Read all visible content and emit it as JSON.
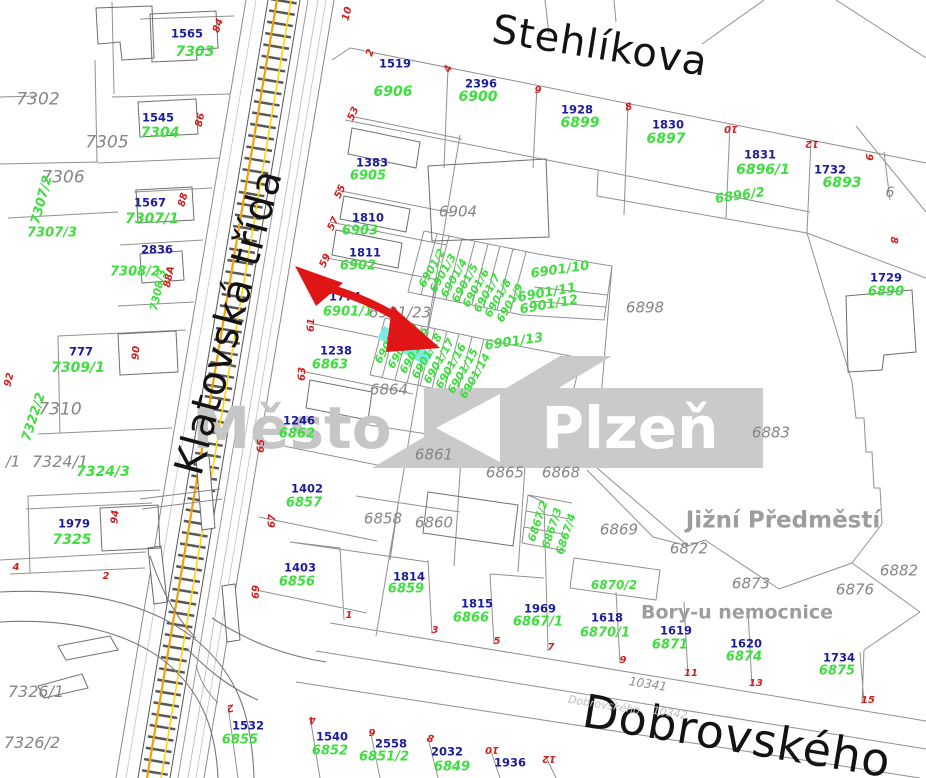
{
  "map": {
    "watermark": {
      "prefix": "Město",
      "city": "Plzeň"
    },
    "labels": [
      {
        "t": "Město",
        "x": 292,
        "y": 428,
        "c": "wm1"
      },
      {
        "t": "Plzeň",
        "x": 630,
        "y": 428,
        "c": "wm2"
      },
      {
        "t": "Stehlíkova",
        "x": 600,
        "y": 46,
        "c": "street",
        "r": 9,
        "s": 40
      },
      {
        "t": "Klatovská třída",
        "x": 229,
        "y": 322,
        "c": "street",
        "r": -75,
        "s": 40
      },
      {
        "t": "Dobrovského",
        "x": 737,
        "y": 736,
        "c": "street",
        "r": 9.5,
        "s": 46
      },
      {
        "t": "Jižní Předměstí",
        "x": 783,
        "y": 521,
        "c": "area",
        "s": 23
      },
      {
        "t": "Bory-u nemocnice",
        "x": 737,
        "y": 613,
        "c": "area",
        "s": 19
      },
      {
        "t": "10341",
        "x": 648,
        "y": 684,
        "c": "road",
        "r": 9
      },
      {
        "t": "Dobrovského",
        "x": 604,
        "y": 705,
        "c": "f",
        "r": 9
      },
      {
        "t": "10342",
        "x": 670,
        "y": 713,
        "c": "f",
        "r": 9
      },
      {
        "t": "7302",
        "x": 38,
        "y": 100,
        "c": "gr",
        "s": 17
      },
      {
        "t": "7305",
        "x": 107,
        "y": 143,
        "c": "gr",
        "s": 17
      },
      {
        "t": "7306",
        "x": 63,
        "y": 178,
        "c": "gr",
        "s": 17
      },
      {
        "t": "7310",
        "x": 60,
        "y": 410,
        "c": "gr",
        "s": 17
      },
      {
        "t": "/1",
        "x": 13,
        "y": 462,
        "c": "gr",
        "s": 15
      },
      {
        "t": "7324/1",
        "x": 60,
        "y": 462,
        "c": "gr",
        "s": 16
      },
      {
        "t": "7326/1",
        "x": 36,
        "y": 692,
        "c": "gr",
        "s": 16
      },
      {
        "t": "7326/2",
        "x": 32,
        "y": 743,
        "c": "gr",
        "s": 16
      },
      {
        "t": "6904",
        "x": 458,
        "y": 212,
        "c": "gr"
      },
      {
        "t": "6901/23",
        "x": 400,
        "y": 313,
        "c": "gr"
      },
      {
        "t": "6898",
        "x": 645,
        "y": 308,
        "c": "gr"
      },
      {
        "t": "6864",
        "x": 389,
        "y": 390,
        "c": "gr"
      },
      {
        "t": "6861",
        "x": 434,
        "y": 455,
        "c": "gr"
      },
      {
        "t": "6865",
        "x": 505,
        "y": 473,
        "c": "gr"
      },
      {
        "t": "6868",
        "x": 561,
        "y": 473,
        "c": "gr"
      },
      {
        "t": "6883",
        "x": 771,
        "y": 433,
        "c": "gr"
      },
      {
        "t": "6858",
        "x": 383,
        "y": 519,
        "c": "gr"
      },
      {
        "t": "6860",
        "x": 434,
        "y": 523,
        "c": "gr"
      },
      {
        "t": "6869",
        "x": 619,
        "y": 530,
        "c": "gr"
      },
      {
        "t": "6872",
        "x": 689,
        "y": 549,
        "c": "gr"
      },
      {
        "t": "6873",
        "x": 751,
        "y": 584,
        "c": "gr"
      },
      {
        "t": "6876",
        "x": 855,
        "y": 590,
        "c": "gr"
      },
      {
        "t": "6882",
        "x": 899,
        "y": 571,
        "c": "gr"
      },
      {
        "t": "6",
        "x": 890,
        "y": 193,
        "c": "gr",
        "s": 14
      },
      {
        "t": "1565",
        "x": 187,
        "y": 34,
        "c": "b"
      },
      {
        "t": "1545",
        "x": 158,
        "y": 118,
        "c": "b"
      },
      {
        "t": "1567",
        "x": 150,
        "y": 203,
        "c": "b"
      },
      {
        "t": "2836",
        "x": 157,
        "y": 250,
        "c": "b"
      },
      {
        "t": "777",
        "x": 81,
        "y": 352,
        "c": "b"
      },
      {
        "t": "1979",
        "x": 74,
        "y": 524,
        "c": "b"
      },
      {
        "t": "1519",
        "x": 395,
        "y": 64,
        "c": "b"
      },
      {
        "t": "2396",
        "x": 481,
        "y": 84,
        "c": "b"
      },
      {
        "t": "1928",
        "x": 577,
        "y": 110,
        "c": "b"
      },
      {
        "t": "1830",
        "x": 668,
        "y": 125,
        "c": "b"
      },
      {
        "t": "1831",
        "x": 760,
        "y": 155,
        "c": "b"
      },
      {
        "t": "1732",
        "x": 830,
        "y": 170,
        "c": "b"
      },
      {
        "t": "1729",
        "x": 886,
        "y": 278,
        "c": "b"
      },
      {
        "t": "1383",
        "x": 372,
        "y": 163,
        "c": "b"
      },
      {
        "t": "1810",
        "x": 368,
        "y": 218,
        "c": "b"
      },
      {
        "t": "1811",
        "x": 365,
        "y": 253,
        "c": "b"
      },
      {
        "t": "1774",
        "x": 345,
        "y": 297,
        "c": "b"
      },
      {
        "t": "1238",
        "x": 336,
        "y": 351,
        "c": "b"
      },
      {
        "t": "1246",
        "x": 299,
        "y": 421,
        "c": "b"
      },
      {
        "t": "1402",
        "x": 307,
        "y": 489,
        "c": "b"
      },
      {
        "t": "1403",
        "x": 300,
        "y": 568,
        "c": "b"
      },
      {
        "t": "1814",
        "x": 409,
        "y": 577,
        "c": "b"
      },
      {
        "t": "1815",
        "x": 477,
        "y": 604,
        "c": "b"
      },
      {
        "t": "1969",
        "x": 540,
        "y": 609,
        "c": "b"
      },
      {
        "t": "1618",
        "x": 607,
        "y": 618,
        "c": "b"
      },
      {
        "t": "1619",
        "x": 676,
        "y": 631,
        "c": "b"
      },
      {
        "t": "1620",
        "x": 746,
        "y": 644,
        "c": "b"
      },
      {
        "t": "1734",
        "x": 839,
        "y": 658,
        "c": "b"
      },
      {
        "t": "1532",
        "x": 248,
        "y": 726,
        "c": "b"
      },
      {
        "t": "1540",
        "x": 332,
        "y": 737,
        "c": "b"
      },
      {
        "t": "2558",
        "x": 391,
        "y": 744,
        "c": "b"
      },
      {
        "t": "2032",
        "x": 447,
        "y": 752,
        "c": "b"
      },
      {
        "t": "1936",
        "x": 510,
        "y": 763,
        "c": "b"
      },
      {
        "t": "7303",
        "x": 195,
        "y": 52,
        "c": "g",
        "s": 14
      },
      {
        "t": "7304",
        "x": 160,
        "y": 133,
        "c": "g",
        "s": 14
      },
      {
        "t": "7307/1",
        "x": 152,
        "y": 219,
        "c": "g",
        "s": 14
      },
      {
        "t": "7307/2",
        "x": 42,
        "y": 200,
        "c": "g",
        "r": -75
      },
      {
        "t": "7307/3",
        "x": 52,
        "y": 233,
        "c": "g"
      },
      {
        "t": "7308/2",
        "x": 135,
        "y": 272,
        "c": "g"
      },
      {
        "t": "7308/3",
        "x": 158,
        "y": 290,
        "c": "g",
        "r": -78,
        "s": 11
      },
      {
        "t": "7309/1",
        "x": 78,
        "y": 368,
        "c": "g",
        "s": 14
      },
      {
        "t": "7322/2",
        "x": 34,
        "y": 417,
        "c": "g",
        "r": -72
      },
      {
        "t": "7324/3",
        "x": 103,
        "y": 472,
        "c": "g",
        "s": 14
      },
      {
        "t": "7325",
        "x": 72,
        "y": 540,
        "c": "g",
        "s": 14
      },
      {
        "t": "6906",
        "x": 393,
        "y": 92,
        "c": "g",
        "s": 14
      },
      {
        "t": "6900",
        "x": 478,
        "y": 97,
        "c": "g",
        "s": 14
      },
      {
        "t": "6899",
        "x": 580,
        "y": 123,
        "c": "g",
        "s": 14
      },
      {
        "t": "6897",
        "x": 666,
        "y": 139,
        "c": "g",
        "s": 14
      },
      {
        "t": "6896/1",
        "x": 763,
        "y": 170,
        "c": "g",
        "s": 14
      },
      {
        "t": "6896/2",
        "x": 740,
        "y": 196,
        "c": "g",
        "r": -8
      },
      {
        "t": "6893",
        "x": 842,
        "y": 183,
        "c": "g",
        "s": 14
      },
      {
        "t": "6890",
        "x": 886,
        "y": 292,
        "c": "g"
      },
      {
        "t": "6905",
        "x": 368,
        "y": 176,
        "c": "g"
      },
      {
        "t": "6903",
        "x": 360,
        "y": 231,
        "c": "g"
      },
      {
        "t": "6902",
        "x": 358,
        "y": 266,
        "c": "g"
      },
      {
        "t": "6901/1",
        "x": 348,
        "y": 312,
        "c": "g"
      },
      {
        "t": "6863",
        "x": 330,
        "y": 365,
        "c": "g"
      },
      {
        "t": "6862",
        "x": 297,
        "y": 434,
        "c": "g"
      },
      {
        "t": "6857",
        "x": 304,
        "y": 503,
        "c": "g"
      },
      {
        "t": "6856",
        "x": 297,
        "y": 582,
        "c": "g"
      },
      {
        "t": "6859",
        "x": 406,
        "y": 589,
        "c": "g"
      },
      {
        "t": "6866",
        "x": 471,
        "y": 618,
        "c": "g"
      },
      {
        "t": "6867/1",
        "x": 538,
        "y": 622,
        "c": "g"
      },
      {
        "t": "6870/1",
        "x": 605,
        "y": 633,
        "c": "g"
      },
      {
        "t": "6870/2",
        "x": 614,
        "y": 585,
        "c": "g",
        "s": 12
      },
      {
        "t": "6871",
        "x": 670,
        "y": 645,
        "c": "g"
      },
      {
        "t": "6874",
        "x": 744,
        "y": 657,
        "c": "g"
      },
      {
        "t": "6875",
        "x": 837,
        "y": 671,
        "c": "g"
      },
      {
        "t": "6855",
        "x": 240,
        "y": 740,
        "c": "g"
      },
      {
        "t": "6852",
        "x": 330,
        "y": 751,
        "c": "g"
      },
      {
        "t": "6851/2",
        "x": 384,
        "y": 757,
        "c": "g"
      },
      {
        "t": "6849",
        "x": 452,
        "y": 767,
        "c": "g"
      },
      {
        "t": "6867/2",
        "x": 538,
        "y": 521,
        "c": "g",
        "r": -72,
        "s": 11
      },
      {
        "t": "6867/3",
        "x": 552,
        "y": 528,
        "c": "g",
        "r": -72,
        "s": 11
      },
      {
        "t": "6867/4",
        "x": 566,
        "y": 534,
        "c": "g",
        "r": -72,
        "s": 11
      },
      {
        "t": "6901/10",
        "x": 560,
        "y": 270,
        "c": "g",
        "r": -8
      },
      {
        "t": "6901/11",
        "x": 547,
        "y": 293,
        "c": "g",
        "r": -10
      },
      {
        "t": "6901/12",
        "x": 549,
        "y": 305,
        "c": "g",
        "r": -10
      },
      {
        "t": "6901/13",
        "x": 514,
        "y": 342,
        "c": "g",
        "r": -8
      },
      {
        "t": "6901/2",
        "x": 432,
        "y": 268,
        "c": "g",
        "r": -60,
        "s": 11
      },
      {
        "t": "6901/3",
        "x": 443,
        "y": 273,
        "c": "g",
        "r": -60,
        "s": 11
      },
      {
        "t": "6901/4",
        "x": 454,
        "y": 278,
        "c": "g",
        "r": -60,
        "s": 11
      },
      {
        "t": "6901/5",
        "x": 465,
        "y": 283,
        "c": "g",
        "r": -60,
        "s": 11
      },
      {
        "t": "6901/6",
        "x": 476,
        "y": 288,
        "c": "g",
        "r": -60,
        "s": 11
      },
      {
        "t": "6901/7",
        "x": 487,
        "y": 293,
        "c": "g",
        "r": -60,
        "s": 11
      },
      {
        "t": "6901/8",
        "x": 498,
        "y": 298,
        "c": "g",
        "r": -60,
        "s": 11
      },
      {
        "t": "6901/9",
        "x": 510,
        "y": 303,
        "c": "g",
        "r": -60,
        "s": 11
      },
      {
        "t": "6901/21",
        "x": 390,
        "y": 341,
        "c": "g",
        "r": -60,
        "s": 11
      },
      {
        "t": "6901/20",
        "x": 403,
        "y": 346,
        "c": "g",
        "r": -60,
        "s": 11
      },
      {
        "t": "6901/19",
        "x": 415,
        "y": 351,
        "c": "g",
        "r": -60,
        "s": 11
      },
      {
        "t": "6901/18",
        "x": 427,
        "y": 356,
        "c": "g",
        "r": -60,
        "s": 11
      },
      {
        "t": "6901/17",
        "x": 439,
        "y": 361,
        "c": "g",
        "r": -60,
        "s": 11
      },
      {
        "t": "6901/16",
        "x": 451,
        "y": 366,
        "c": "g",
        "r": -60,
        "s": 11
      },
      {
        "t": "6901/15",
        "x": 463,
        "y": 371,
        "c": "g",
        "r": -60,
        "s": 11
      },
      {
        "t": "6901/14",
        "x": 475,
        "y": 376,
        "c": "g",
        "r": -60,
        "s": 11
      },
      {
        "t": "84",
        "x": 219,
        "y": 26,
        "c": "r",
        "r": -70
      },
      {
        "t": "86",
        "x": 201,
        "y": 120,
        "c": "r",
        "r": -78
      },
      {
        "t": "88",
        "x": 184,
        "y": 200,
        "c": "r",
        "r": -75
      },
      {
        "t": "88A",
        "x": 170,
        "y": 277,
        "c": "r",
        "r": -78
      },
      {
        "t": "90",
        "x": 137,
        "y": 353,
        "c": "r",
        "r": -85
      },
      {
        "t": "92",
        "x": 10,
        "y": 380,
        "c": "r",
        "r": -75
      },
      {
        "t": "94",
        "x": 116,
        "y": 517,
        "c": "r",
        "r": -85
      },
      {
        "t": "4",
        "x": 16,
        "y": 568,
        "c": "r"
      },
      {
        "t": "2",
        "x": 106,
        "y": 577,
        "c": "r"
      },
      {
        "t": "53",
        "x": 354,
        "y": 114,
        "c": "r",
        "r": -65
      },
      {
        "t": "55",
        "x": 341,
        "y": 192,
        "c": "r",
        "r": -65
      },
      {
        "t": "57",
        "x": 334,
        "y": 224,
        "c": "r",
        "r": -65
      },
      {
        "t": "59",
        "x": 326,
        "y": 261,
        "c": "r",
        "r": -65
      },
      {
        "t": "61",
        "x": 312,
        "y": 325,
        "c": "r",
        "r": -88
      },
      {
        "t": "63",
        "x": 303,
        "y": 374,
        "c": "r",
        "r": -88
      },
      {
        "t": "65",
        "x": 262,
        "y": 446,
        "c": "r",
        "r": -88
      },
      {
        "t": "67",
        "x": 273,
        "y": 521,
        "c": "r",
        "r": -88
      },
      {
        "t": "69",
        "x": 257,
        "y": 592,
        "c": "r",
        "r": -88
      },
      {
        "t": "10",
        "x": 348,
        "y": 14,
        "c": "r",
        "r": -75
      },
      {
        "t": "2",
        "x": 371,
        "y": 53,
        "c": "r",
        "r": -70
      },
      {
        "t": "4",
        "x": 449,
        "y": 69,
        "c": "r",
        "r": -70
      },
      {
        "t": "6",
        "x": 538,
        "y": 88,
        "c": "r",
        "r": 180
      },
      {
        "t": "8",
        "x": 629,
        "y": 108,
        "c": "r",
        "r": -15
      },
      {
        "t": "10",
        "x": 731,
        "y": 128,
        "c": "r",
        "r": 180
      },
      {
        "t": "12",
        "x": 812,
        "y": 143,
        "c": "r",
        "r": 180
      },
      {
        "t": "9",
        "x": 868,
        "y": 157,
        "c": "r",
        "r": 95
      },
      {
        "t": "8",
        "x": 893,
        "y": 240,
        "c": "r",
        "r": 95
      },
      {
        "t": "1",
        "x": 349,
        "y": 616,
        "c": "r"
      },
      {
        "t": "3",
        "x": 435,
        "y": 631,
        "c": "r"
      },
      {
        "t": "5",
        "x": 497,
        "y": 642,
        "c": "r"
      },
      {
        "t": "7",
        "x": 551,
        "y": 648,
        "c": "r"
      },
      {
        "t": "9",
        "x": 623,
        "y": 661,
        "c": "r"
      },
      {
        "t": "11",
        "x": 691,
        "y": 674,
        "c": "r"
      },
      {
        "t": "13",
        "x": 756,
        "y": 684,
        "c": "r"
      },
      {
        "t": "15",
        "x": 868,
        "y": 701,
        "c": "r"
      },
      {
        "t": "2",
        "x": 230,
        "y": 707,
        "c": "r",
        "r": 170
      },
      {
        "t": "4",
        "x": 312,
        "y": 719,
        "c": "r",
        "r": 170
      },
      {
        "t": "6",
        "x": 372,
        "y": 731,
        "c": "r",
        "r": 180
      },
      {
        "t": "8",
        "x": 430,
        "y": 740,
        "c": "r",
        "r": 15
      },
      {
        "t": "10",
        "x": 492,
        "y": 749,
        "c": "r",
        "r": 180
      },
      {
        "t": "12",
        "x": 549,
        "y": 758,
        "c": "r",
        "r": 180
      }
    ]
  }
}
